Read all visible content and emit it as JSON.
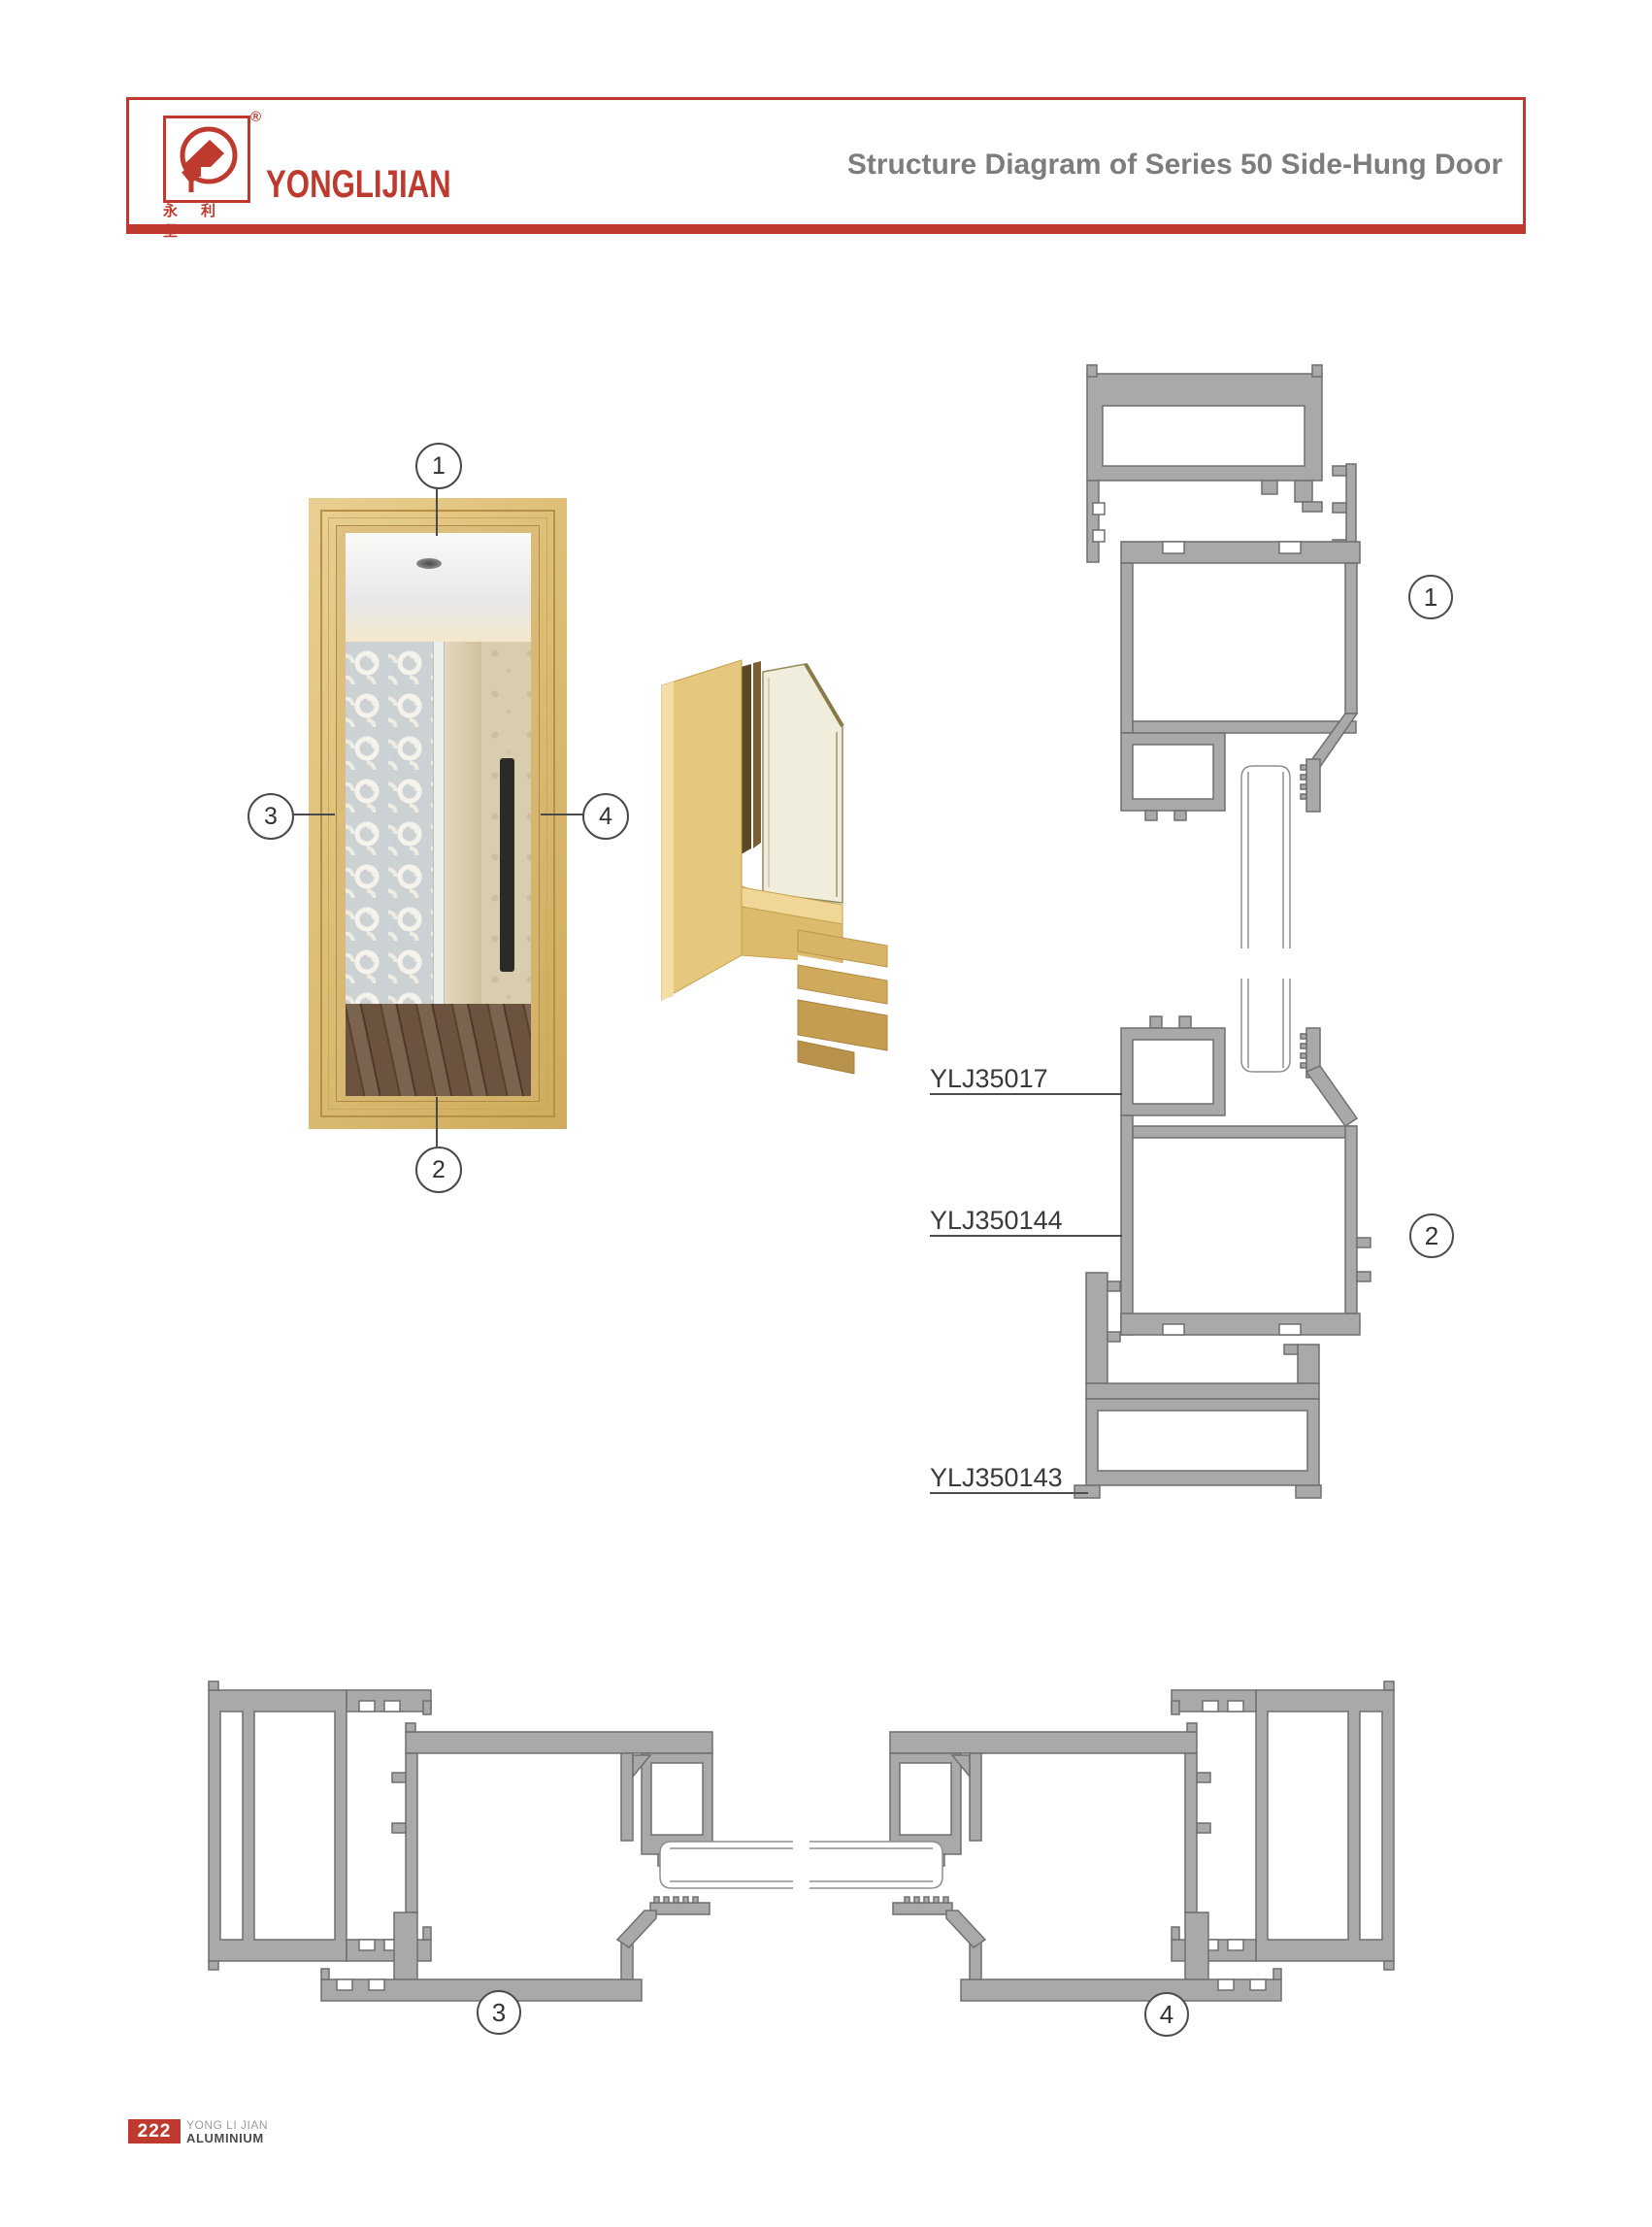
{
  "header": {
    "brand": "YONGLIJIAN",
    "brand_cn": "永利坚",
    "registered_mark": "®",
    "title": "Structure Diagram of Series 50 Side-Hung Door"
  },
  "labels": {
    "l1": "YLJ35017",
    "l2": "YLJ350144",
    "l3": "YLJ350143"
  },
  "sections": {
    "s1": "1",
    "s2": "2",
    "s3": "3",
    "s4": "4"
  },
  "callouts": {
    "c1": "1",
    "c2": "2",
    "c3": "3",
    "c4": "4"
  },
  "footer": {
    "page_number": "222",
    "line1": "YONG LI JIAN",
    "line2": "ALUMINIUM"
  },
  "colors": {
    "brand_red": "#bf3a2e",
    "title_gray": "#7d7d80",
    "profile_gray": "#a9a9a9",
    "profile_outline": "#6f6f6f",
    "gold": "#e0bd74"
  }
}
